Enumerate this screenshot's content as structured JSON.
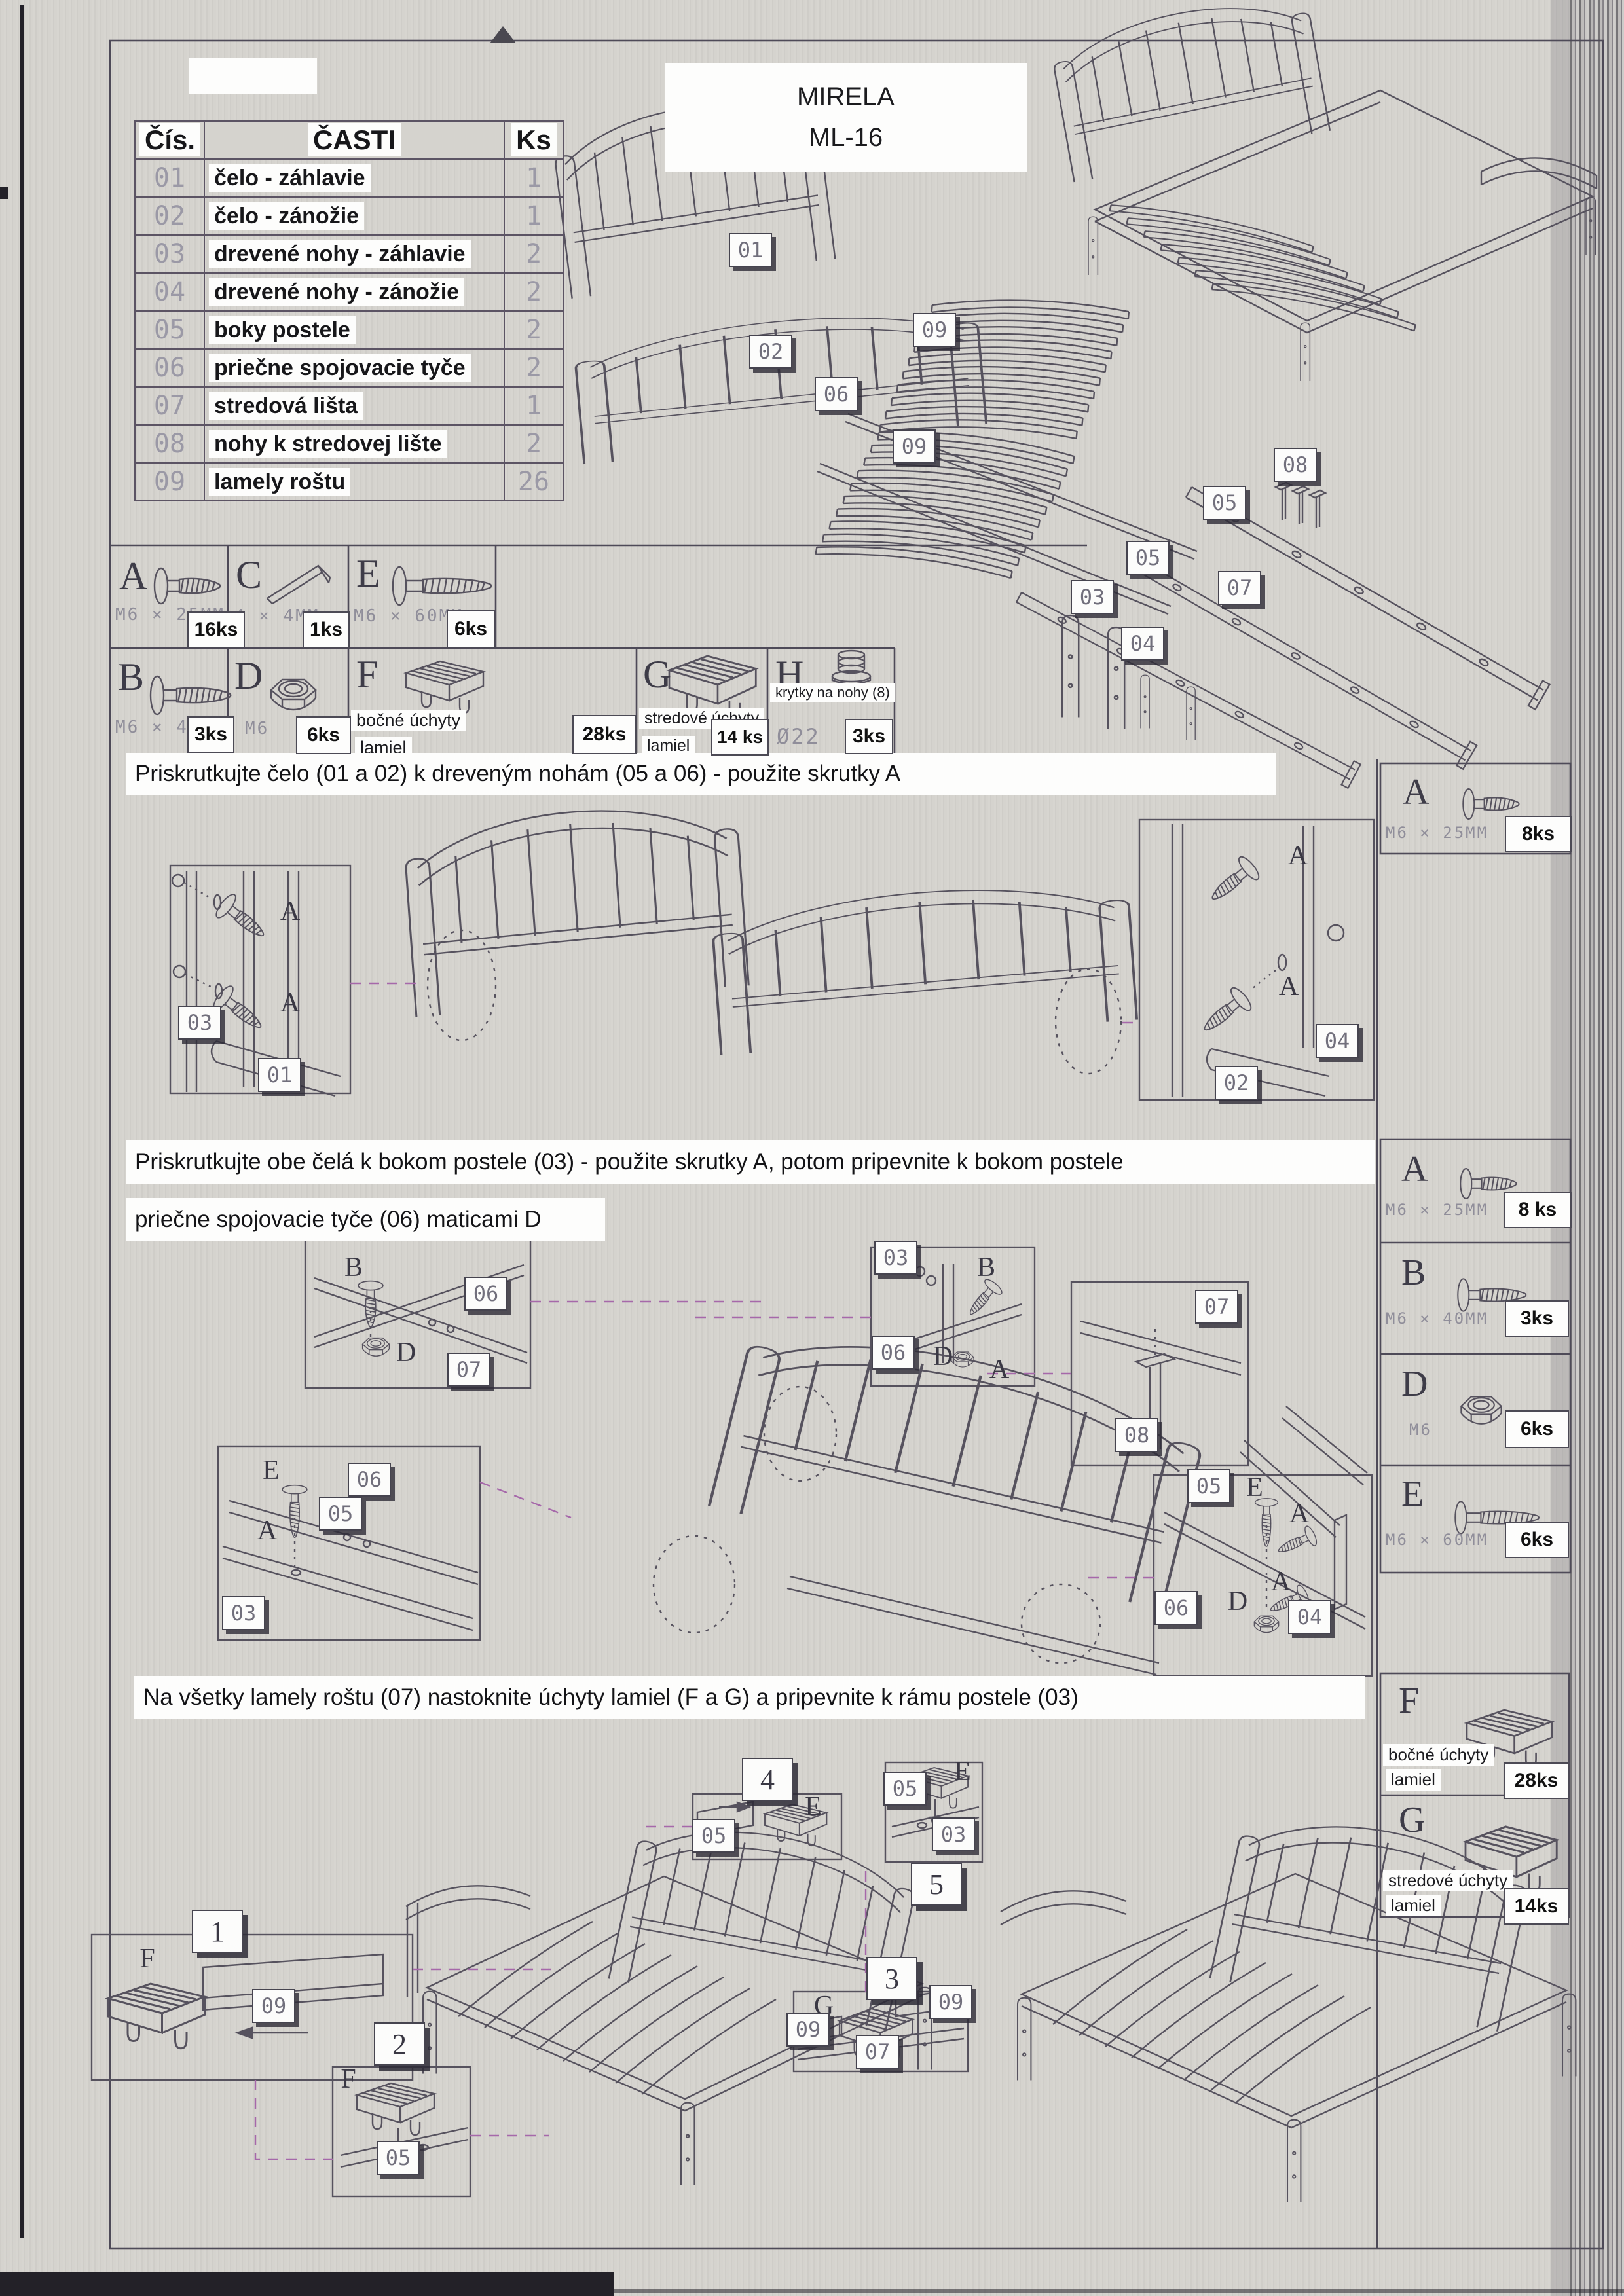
{
  "title": {
    "line1": "MIRELA",
    "line2": "ML-16"
  },
  "parts_table": {
    "headers": [
      "Čís.",
      "ČASTI",
      "Ks"
    ],
    "rows": [
      [
        "01",
        "čelo - záhlavie",
        "1"
      ],
      [
        "02",
        "čelo - zánožie",
        "1"
      ],
      [
        "03",
        "drevené nohy - záhlavie",
        "2"
      ],
      [
        "04",
        "drevené nohy - zánožie",
        "2"
      ],
      [
        "05",
        "boky postele",
        "2"
      ],
      [
        "06",
        "priečne spojovacie tyče",
        "2"
      ],
      [
        "07",
        "stredová lišta",
        "1"
      ],
      [
        "08",
        "nohy k stredovej lište",
        "2"
      ],
      [
        "09",
        "lamely roštu",
        "26"
      ]
    ]
  },
  "hardware_main": {
    "a": {
      "letter": "A",
      "spec": "M6 × 25MM",
      "qty": "16ks",
      "icon": "screw-short-icon"
    },
    "c": {
      "letter": "C",
      "spec": "4 × 4MM",
      "qty": "1ks",
      "icon": "allen-key-icon"
    },
    "e": {
      "letter": "E",
      "spec": "M6 × 60MM",
      "qty": "6ks",
      "icon": "screw-long-icon"
    },
    "b": {
      "letter": "B",
      "spec": "M6 × 40MM",
      "qty": "3ks",
      "icon": "screw-medium-icon"
    },
    "d": {
      "letter": "D",
      "spec": "M6",
      "qty": "6ks",
      "icon": "nut-icon"
    },
    "f": {
      "letter": "F",
      "desc1": "bočné úchyty",
      "desc2": "lamiel",
      "qty": "28ks",
      "icon": "side-slat-holder-icon"
    },
    "g": {
      "letter": "G",
      "desc1": "stredové úchyty",
      "desc2": "lamiel",
      "qty": "14 ks",
      "icon": "center-slat-holder-icon"
    },
    "h": {
      "letter": "H",
      "desc": "krytky na nohy (8)",
      "spec": "Ø22",
      "qty": "3ks",
      "icon": "leg-cap-icon"
    }
  },
  "steps": {
    "s1": {
      "text": "Priskrutkujte čelo (01 a 02) k dreveným nohám (05 a 06) - použite skrutky A",
      "hw_a": {
        "letter": "A",
        "spec": "M6 × 25MM",
        "qty": "8ks"
      }
    },
    "s2": {
      "line1": "Priskrutkujte obe čelá k bokom postele (03) - použite skrutky A, potom pripevnite k bokom postele",
      "line2": "priečne spojovacie tyče (06) maticami D",
      "hw_a": {
        "letter": "A",
        "spec": "M6 × 25MM",
        "qty": "8 ks"
      },
      "hw_b": {
        "letter": "B",
        "spec": "M6 × 40MM",
        "qty": "3ks"
      },
      "hw_d": {
        "letter": "D",
        "spec": "M6",
        "qty": "6ks"
      },
      "hw_e": {
        "letter": "E",
        "spec": "M6 × 60MM",
        "qty": "6ks"
      }
    },
    "s3": {
      "text": "Na všetky lamely roštu (07) nastoknite úchyty lamiel (F a G) a pripevnite k rámu postele (03)",
      "hw_f": {
        "letter": "F",
        "desc1": "bočné úchyty",
        "desc2": "lamiel",
        "qty": "28ks"
      },
      "hw_g": {
        "letter": "G",
        "desc1": "stredové úchyty",
        "desc2": "lamiel",
        "qty": "14ks"
      }
    }
  },
  "tags": {
    "exploded": [
      "01",
      "02",
      "06",
      "09",
      "09",
      "08",
      "05",
      "05",
      "07",
      "03",
      "04"
    ],
    "step1": [
      "A",
      "A",
      "03",
      "01",
      "A",
      "A",
      "04",
      "02"
    ],
    "step2": [
      "B",
      "06",
      "D",
      "07",
      "03",
      "B",
      "06",
      "D",
      "A",
      "07",
      "08",
      "E",
      "06",
      "A",
      "03",
      "05",
      "05",
      "E",
      "A",
      "A",
      "D",
      "06",
      "04"
    ],
    "step3": [
      "1",
      "F",
      "09",
      "2",
      "F",
      "05",
      "4",
      "05",
      "E",
      "5",
      "E",
      "05",
      "03",
      "3",
      "G",
      "09",
      "09",
      "07"
    ]
  }
}
